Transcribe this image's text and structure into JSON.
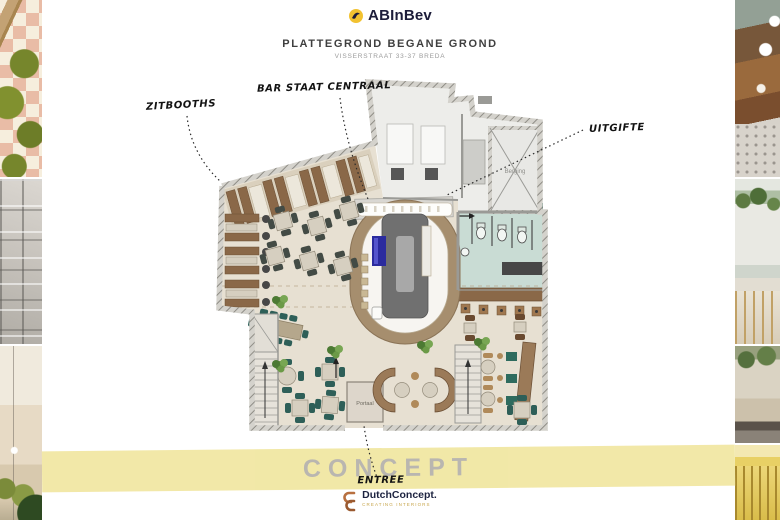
{
  "header": {
    "brand": "ABInBev",
    "title": "PLATTEGROND BEGANE GROND",
    "subtitle": "VISSERSTRAAT 33-37 BREDA"
  },
  "annotations": {
    "zitbooths": "ZITBOOTHS",
    "bar_centraal": "BAR STAAT CENTRAAL",
    "uitgifte": "UITGIFTE",
    "entree": "ENTREE"
  },
  "plan_labels": {
    "berging": "Berging",
    "portaal": "Portaal"
  },
  "watermark": {
    "text": "CONCEPT",
    "band_color": "#f1e7a3",
    "text_color": "#b6b3ac"
  },
  "footer": {
    "brand": "DutchConcept.",
    "tagline": "CREATING INTERIORS"
  },
  "colors": {
    "brand_navy": "#1d1d3a",
    "logo_gold": "#f2c230",
    "accent_orange": "#b87040",
    "floor_beige": "#e7e0d2",
    "booth_brown": "#8a6848",
    "bar_ring_tan": "#a68e6e",
    "bar_island_gray": "#707070",
    "wc_teal": "#c9dcd4",
    "chair_teal": "#2e5f58",
    "tap_blue": "#2b2b9e"
  },
  "photos": {
    "left": [
      "tiled-floor-green-poufs",
      "coffered-ceiling",
      "cafe-interior-green-stools"
    ],
    "right": [
      "brown-leather-booths",
      "bar-hanging-plants",
      "restaurant-greenery",
      "yellow-bar-stools"
    ]
  }
}
